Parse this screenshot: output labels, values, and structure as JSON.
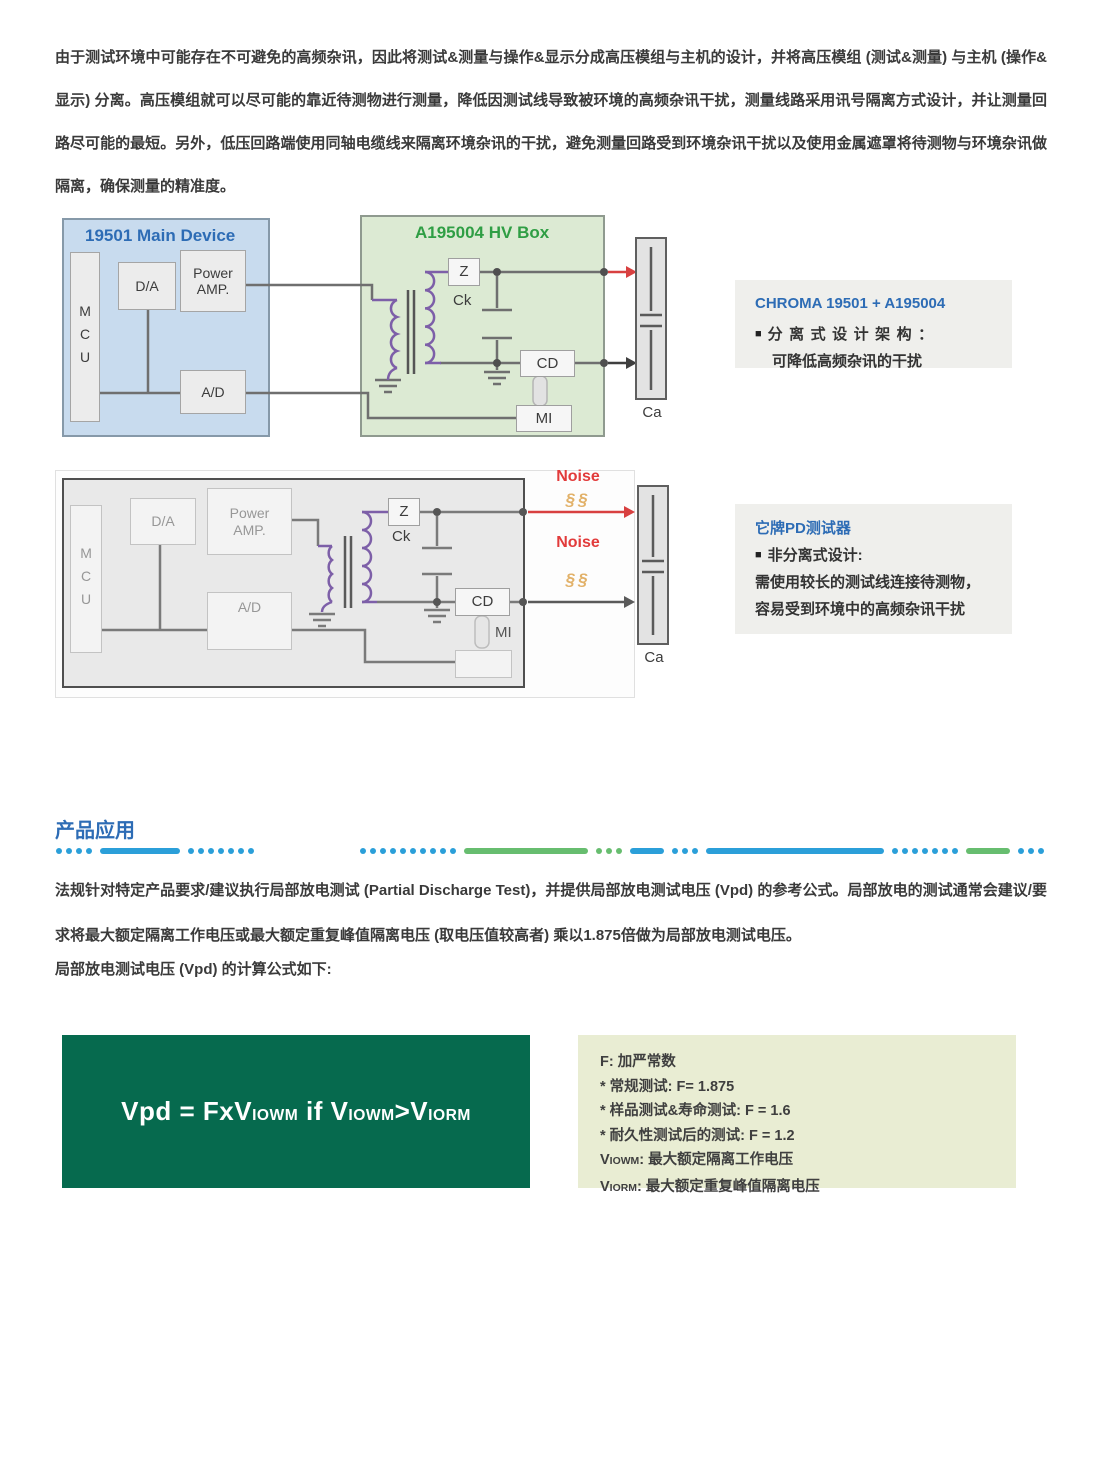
{
  "page": {
    "intro": "由于测试环境中可能存在不可避免的高频杂讯，因此将测试&测量与操作&显示分成高压模组与主机的设计，并将高压模组 (测试&测量) 与主机 (操作&显示) 分离。高压模组就可以尽可能的靠近待测物进行测量，降低因测试线导致被环境的高频杂讯干扰，测量线路采用讯号隔离方式设计，并让测量回路尽可能的最短。另外，低压回路端使用同轴电缆线来隔离环境杂讯的干扰，避免测量回路受到环境杂讯干扰以及使用金属遮罩将待测物与环境杂讯做隔离，确保测量的精准度。",
    "section_title": "产品应用",
    "para2": "法规针对特定产品要求/建议执行局部放电测试 (Partial Discharge Test)，并提供局部放电测试电压 (Vpd) 的参考公式。局部放电的测试通常会建议/要求将最大额定隔离工作电压或最大额定重复峰值隔离电压 (取电压值较高者) 乘以1.875倍做为局部放电测试电压。",
    "para3": "局部放电测试电压 (Vpd) 的计算公式如下:"
  },
  "diagram1": {
    "main_title": "19501 Main Device",
    "hv_title": "A195004 HV Box",
    "mcu": "MCU",
    "da": "D/A",
    "power_amp": "Power AMP.",
    "ad": "A/D",
    "z": "Z",
    "ck": "Ck",
    "cd": "CD",
    "mi": "MI",
    "ca": "Ca"
  },
  "note1": {
    "title": "CHROMA 19501 + A195004",
    "bullet": "■",
    "line1": "分离式设计架构：",
    "line2": "可降低高频杂讯的干扰"
  },
  "diagram2": {
    "mcu": "MCU",
    "da": "D/A",
    "power_amp": "Power AMP.",
    "ad": "A/D",
    "z": "Z",
    "ck": "Ck",
    "cd": "CD",
    "mi": "MI",
    "ca": "Ca",
    "noise1": "Noise",
    "noise2": "Noise",
    "squiggle": "§§"
  },
  "note2": {
    "title": "它牌PD测试器",
    "bullet": "■",
    "line1": "非分离式设计:",
    "line2": "需使用较长的测试线连接待测物，",
    "line3": "容易受到环境中的高频杂讯干扰"
  },
  "formula": {
    "parts": [
      {
        "t": "Vpd = FxV"
      },
      {
        "t": "IOWM",
        "small": true
      },
      {
        "t": " if V"
      },
      {
        "t": "IOWM",
        "small": true
      },
      {
        "t": ">V"
      },
      {
        "t": "IORM",
        "small": true
      }
    ]
  },
  "legend": {
    "lines": [
      [
        {
          "t": "F: 加严常数"
        }
      ],
      [
        {
          "t": "* 常规测试: F= 1.875"
        }
      ],
      [
        {
          "t": "* 样品测试&寿命测试: F = 1.6"
        }
      ],
      [
        {
          "t": "* 耐久性测试后的测试: F = 1.2"
        }
      ],
      [
        {
          "t": "V"
        },
        {
          "t": "IOWM",
          "small": true
        },
        {
          "t": ": 最大额定隔离工作电压"
        }
      ],
      [
        {
          "t": "V"
        },
        {
          "t": "IORM",
          "small": true
        },
        {
          "t": ": 最大额定重复峰值隔离电压"
        }
      ]
    ]
  },
  "colors": {
    "accent_blue": "#2d6cb5",
    "accent_green": "#2f9e44",
    "note_bg": "#efefec",
    "main_device_bg": "#c8dbee",
    "hv_box_bg": "#dcead3",
    "formula_bg": "#066a4e",
    "legend_bg": "#e9edd3",
    "noise_red": "#e23b3b",
    "squiggle_orange": "#e2b168",
    "divider_blue": "#2b9fd9",
    "divider_green": "#67bd6f",
    "coil_purple": "#7d5fa8"
  }
}
